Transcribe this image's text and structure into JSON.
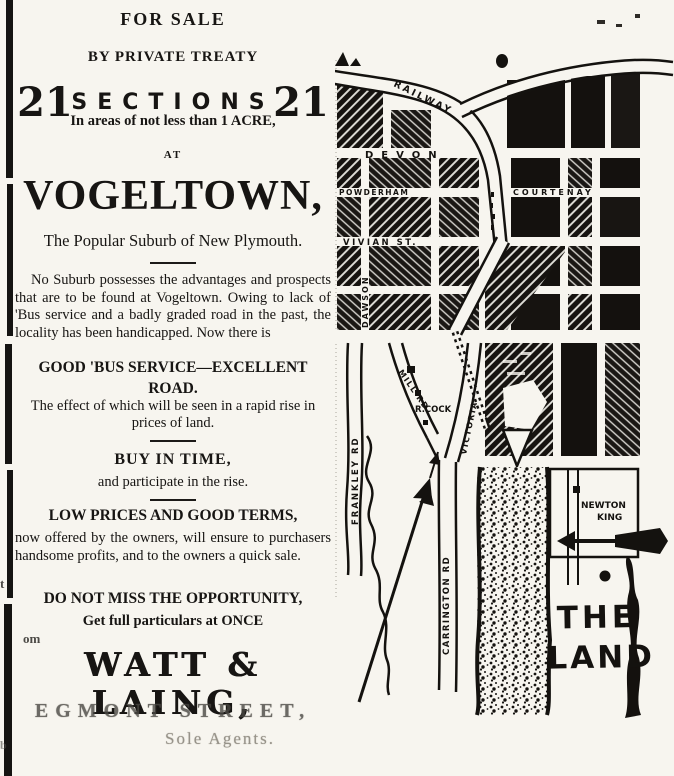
{
  "page_colors": {
    "paper": "#f7f5ef",
    "ink": "#171513"
  },
  "ad": {
    "for_sale": "FOR SALE",
    "by_private_treaty": "BY PRIVATE TREATY",
    "sections_count_left": "21",
    "sections_word": "SECTIONS",
    "sections_count_right": "21",
    "areas_line": "In areas of not less than 1 ACRE,",
    "at_word": "AT",
    "town_name": "VOGELTOWN,",
    "suburb_line": "The Popular Suburb of New Plymouth.",
    "para1": "No Suburb possesses the advantages and prospects that are to be found at Vogeltown. Owing to lack of 'Bus service and a badly graded road in the past, the locality has been handicapped.   Now there is",
    "bus_service_line": "GOOD 'BUS SERVICE—EXCELLENT ROAD.",
    "effect_line": "The effect of which will be seen in a rapid rise in prices of land.",
    "buy_in_time": "BUY IN TIME,",
    "participate_line": "and participate in the rise.",
    "low_prices": "LOW PRICES AND GOOD TERMS,",
    "para2": "now offered by the owners, will ensure to purchasers handsome profits, and to the owners a quick sale.",
    "opportunity_line": "DO NOT MISS THE OPPORTUNITY,",
    "particulars_line": "Get full particulars at ONCE",
    "agency_name": "WATT & LAING,",
    "agency_street": "EGMONT STREET,",
    "agency_role": "Sole Agents.",
    "stray_om": "om",
    "stray_t": "t",
    "stray_b": "b"
  },
  "map": {
    "labels": {
      "railway": "RAILWAY",
      "devon": "DEVON",
      "powderham": "POWDERHAM",
      "courtenay": "COURTENAY",
      "vivian": "VIVIAN  ST.",
      "dawson": "DAWSON",
      "frankley": "FRANKLEY RD",
      "mill": "MILL RD.",
      "victoria": "VICTORIA",
      "carrington": "CARRINGTON RD",
      "rcock": "R.COCK",
      "newton_line1": "NEWTON",
      "newton_line2": "KING",
      "land_line1": "THE",
      "land_line2": "LAND"
    }
  }
}
